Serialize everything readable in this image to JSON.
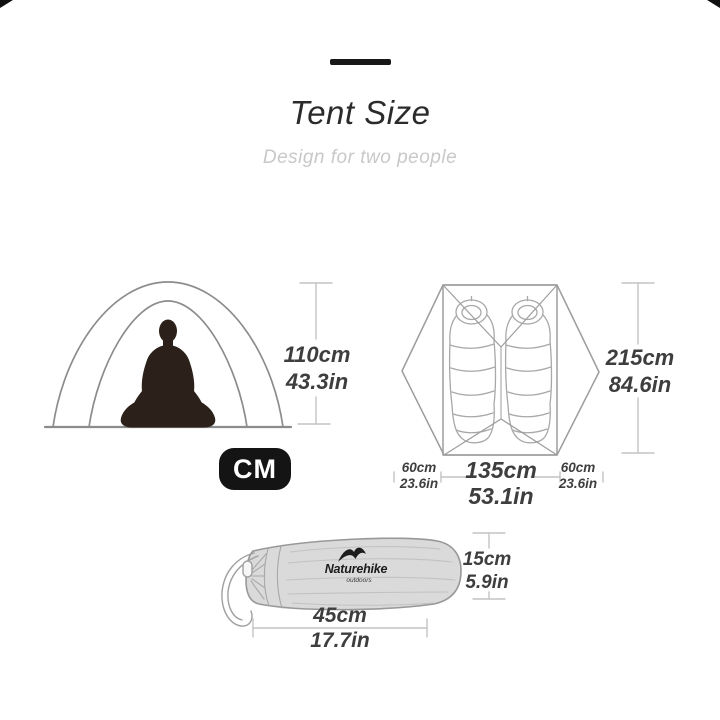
{
  "header": {
    "title": "Tent Size",
    "subtitle": "Design for two people"
  },
  "unit_badge": {
    "label": "CM"
  },
  "measurements": {
    "tent_height": {
      "cm": "110cm",
      "inch": "43.3in"
    },
    "tent_length": {
      "cm": "215cm",
      "inch": "84.6in"
    },
    "vestibule_left": {
      "cm": "60cm",
      "inch": "23.6in"
    },
    "inner_width": {
      "cm": "135cm",
      "inch": "53.1in"
    },
    "vestibule_right": {
      "cm": "60cm",
      "inch": "23.6in"
    },
    "bag_height": {
      "cm": "15cm",
      "inch": "5.9in"
    },
    "bag_length": {
      "cm": "45cm",
      "inch": "17.7in"
    }
  },
  "carry_bag": {
    "brand": "Naturehike",
    "brand_sub": "outdoors"
  },
  "illustrations": {
    "front_view": "tent-front-view-with-seated-person",
    "top_view": "tent-top-view-with-two-sleeping-bags",
    "carry_bag": "tent-carry-bag-with-drawstring"
  },
  "colors": {
    "title_text": "#2b2b2b",
    "subtitle_text": "#c8c8c8",
    "dimension_text": "#3e3e3e",
    "dimension_line": "#c3c3c3",
    "outline_gray": "#9a9a9a",
    "silhouette": "#2b211a",
    "badge_bg": "#141414",
    "badge_text": "#ffffff",
    "bag_fill": "#dadada"
  }
}
